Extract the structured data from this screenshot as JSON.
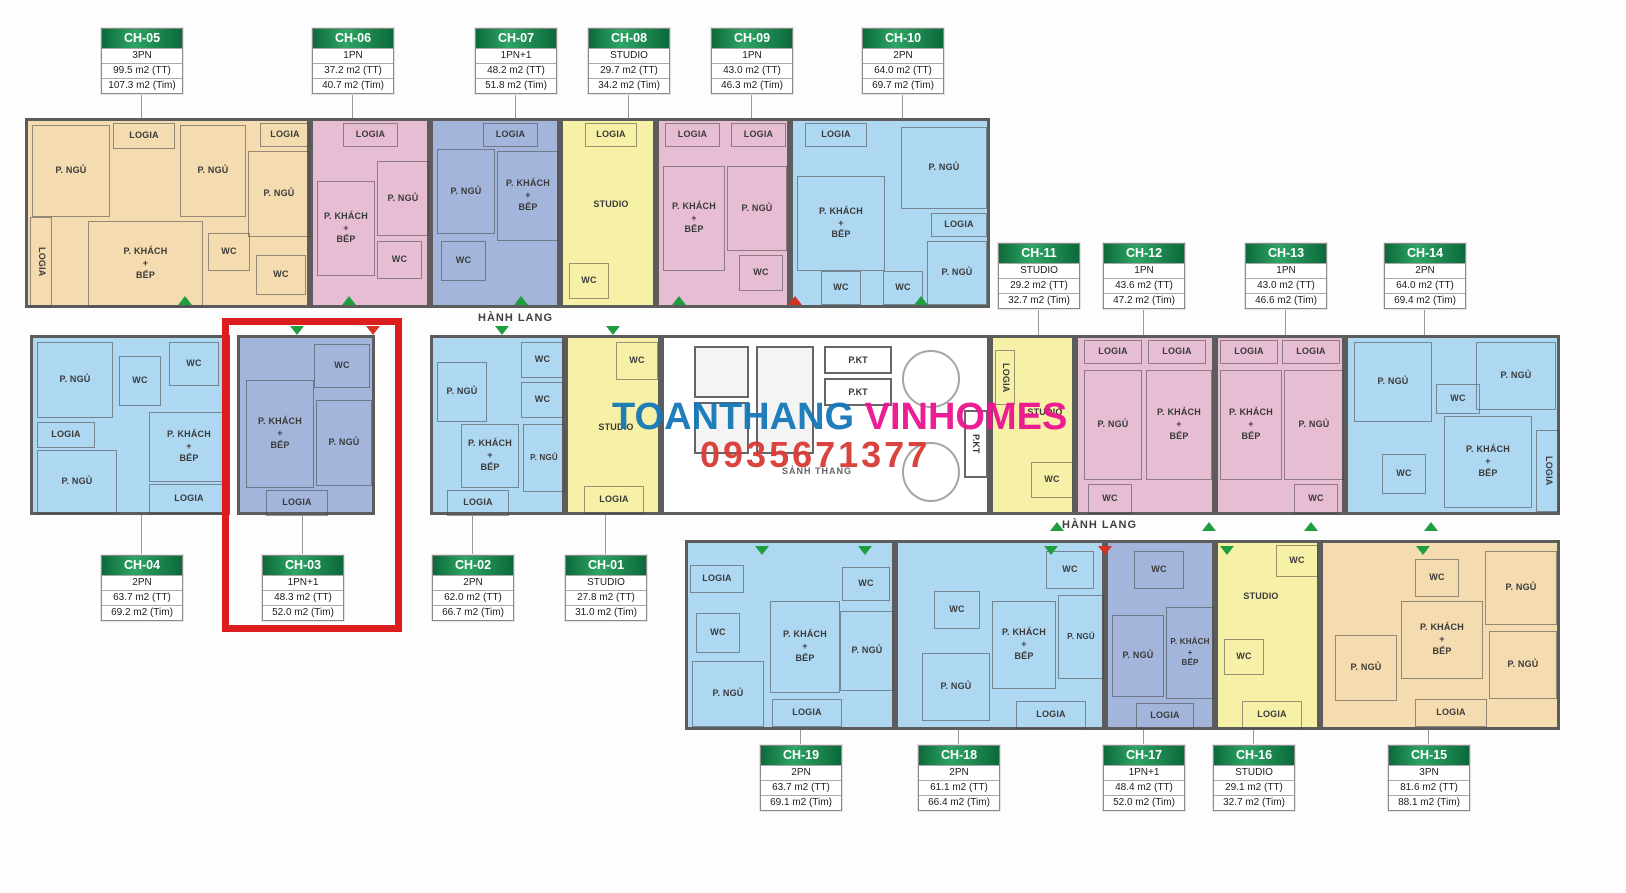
{
  "watermark": {
    "brand_blue": "TOANTHANG",
    "brand_pink": "VINHOMES",
    "phone": "0935671377"
  },
  "labels": {
    "bedroom": "P. NGỦ",
    "living": "P. KHÁCH",
    "plus": "+",
    "kitchen": "BẾP",
    "wc": "WC",
    "logia": "LOGIA",
    "studio": "STUDIO",
    "corridor": "HÀNH LANG",
    "pkt": "P.KT",
    "lobby": "SẢNH THANG"
  },
  "colors": {
    "unit_peach": "#f4dcb0",
    "unit_pink": "#e6bdd3",
    "unit_blue": "#aed8f2",
    "unit_periwinkle": "#a3b5da",
    "unit_yellow": "#f6f1a6",
    "header_green": "#0b6a3a",
    "highlight_red": "#dc1d1d",
    "brand_blue": "#1578b8",
    "brand_pink": "#ec1290",
    "phone_red": "#d93a35",
    "door_marker_green": "#1e9e3e"
  },
  "units": {
    "ch01": {
      "id": "CH-01",
      "type": "STUDIO",
      "tt": "27.8 m2 (TT)",
      "tim": "31.0 m2 (Tim)"
    },
    "ch02": {
      "id": "CH-02",
      "type": "2PN",
      "tt": "62.0 m2 (TT)",
      "tim": "66.7 m2 (Tim)"
    },
    "ch03": {
      "id": "CH-03",
      "type": "1PN+1",
      "tt": "48.3 m2 (TT)",
      "tim": "52.0 m2 (Tim)"
    },
    "ch04": {
      "id": "CH-04",
      "type": "2PN",
      "tt": "63.7 m2 (TT)",
      "tim": "69.2 m2 (Tim)"
    },
    "ch05": {
      "id": "CH-05",
      "type": "3PN",
      "tt": "99.5 m2 (TT)",
      "tim": "107.3 m2 (Tim)"
    },
    "ch06": {
      "id": "CH-06",
      "type": "1PN",
      "tt": "37.2 m2 (TT)",
      "tim": "40.7 m2 (Tim)"
    },
    "ch07": {
      "id": "CH-07",
      "type": "1PN+1",
      "tt": "48.2 m2 (TT)",
      "tim": "51.8 m2 (Tim)"
    },
    "ch08": {
      "id": "CH-08",
      "type": "STUDIO",
      "tt": "29.7 m2 (TT)",
      "tim": "34.2 m2 (Tim)"
    },
    "ch09": {
      "id": "CH-09",
      "type": "1PN",
      "tt": "43.0 m2 (TT)",
      "tim": "46.3 m2 (Tim)"
    },
    "ch10": {
      "id": "CH-10",
      "type": "2PN",
      "tt": "64.0 m2 (TT)",
      "tim": "69.7 m2 (Tim)"
    },
    "ch11": {
      "id": "CH-11",
      "type": "STUDIO",
      "tt": "29.2 m2 (TT)",
      "tim": "32.7 m2 (Tim)"
    },
    "ch12": {
      "id": "CH-12",
      "type": "1PN",
      "tt": "43.6 m2 (TT)",
      "tim": "47.2 m2 (Tim)"
    },
    "ch13": {
      "id": "CH-13",
      "type": "1PN",
      "tt": "43.0 m2 (TT)",
      "tim": "46.6 m2 (Tim)"
    },
    "ch14": {
      "id": "CH-14",
      "type": "2PN",
      "tt": "64.0 m2 (TT)",
      "tim": "69.4 m2 (Tim)"
    },
    "ch15": {
      "id": "CH-15",
      "type": "3PN",
      "tt": "81.6 m2 (TT)",
      "tim": "88.1 m2 (Tim)"
    },
    "ch16": {
      "id": "CH-16",
      "type": "STUDIO",
      "tt": "29.1 m2 (TT)",
      "tim": "32.7 m2 (Tim)"
    },
    "ch17": {
      "id": "CH-17",
      "type": "1PN+1",
      "tt": "48.4 m2 (TT)",
      "tim": "52.0 m2 (Tim)"
    },
    "ch18": {
      "id": "CH-18",
      "type": "2PN",
      "tt": "61.1 m2 (TT)",
      "tim": "66.4 m2 (Tim)"
    },
    "ch19": {
      "id": "CH-19",
      "type": "2PN",
      "tt": "63.7 m2 (TT)",
      "tim": "69.1 m2 (Tim)"
    }
  }
}
